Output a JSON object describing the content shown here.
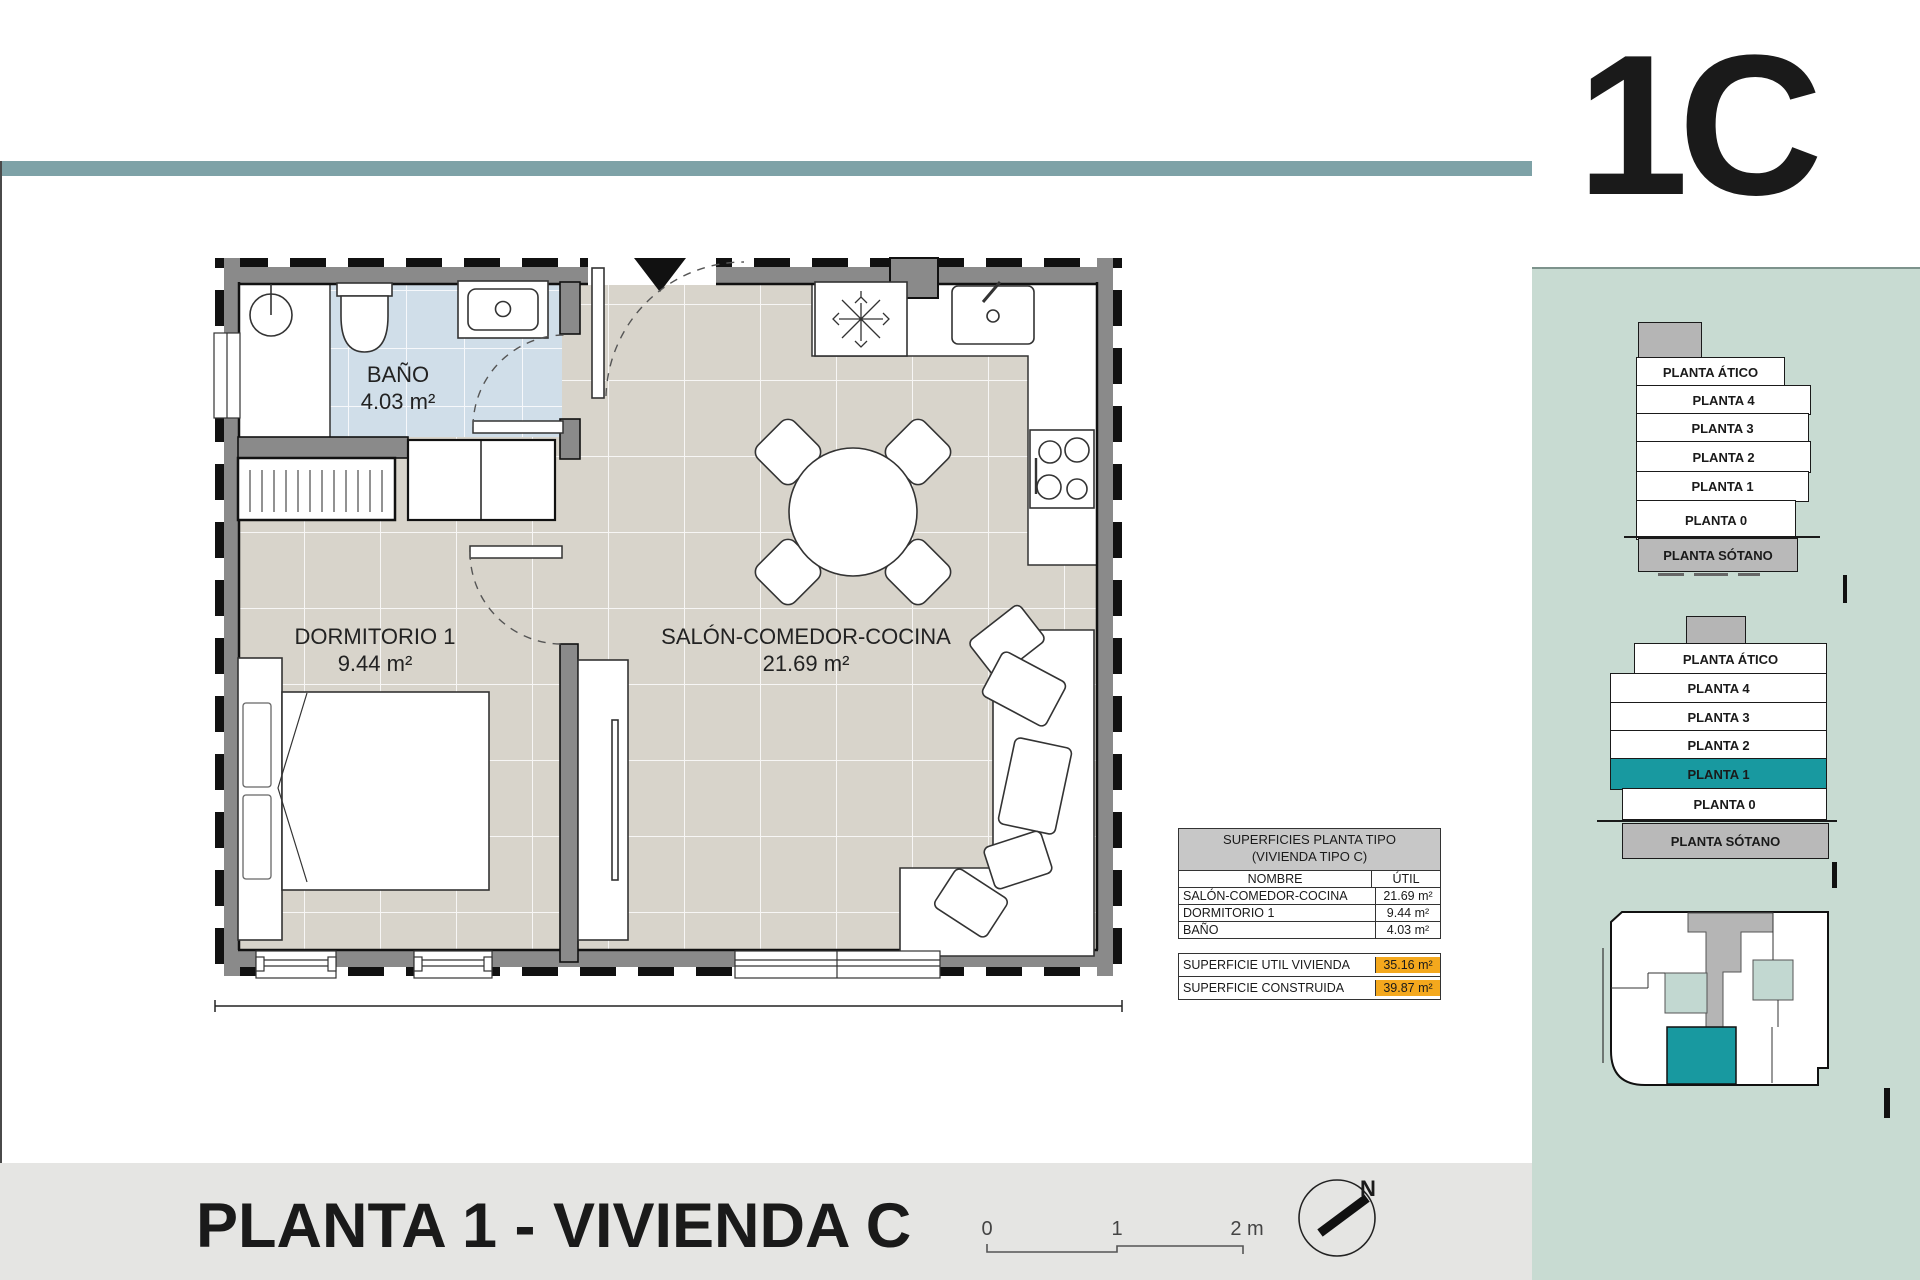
{
  "unit_label": "1C",
  "colors": {
    "accent_teal": "#1899A0",
    "ribbon": "#7EA2A7",
    "panel_bg": "#C8DBD2",
    "total_highlight": "#F4A81D",
    "bath_floor": "#D0DEE9",
    "main_floor": "#D8D4CB"
  },
  "rooms": {
    "bano": {
      "name": "BAÑO",
      "area": "4.03 m²"
    },
    "dormitorio": {
      "name": "DORMITORIO 1",
      "area": "9.44 m²"
    },
    "salon": {
      "name": "SALÓN-COMEDOR-COCINA",
      "area": "21.69 m²"
    }
  },
  "surface_table": {
    "title_line1": "SUPERFICIES PLANTA TIPO",
    "title_line2": "(VIVIENDA TIPO C)",
    "columns": {
      "name": "NOMBRE",
      "util": "ÚTIL"
    },
    "rows": [
      {
        "name": "SALÓN-COMEDOR-COCINA",
        "util": "21.69 m²"
      },
      {
        "name": "DORMITORIO 1",
        "util": "9.44 m²"
      },
      {
        "name": "BAÑO",
        "util": "4.03 m²"
      }
    ],
    "totals": [
      {
        "name": "SUPERFICIE UTIL VIVIENDA",
        "util": "35.16 m²"
      },
      {
        "name": "SUPERFICIE CONSTRUIDA",
        "util": "39.87 m²"
      }
    ]
  },
  "stack_upper": {
    "levels": [
      "PLANTA ÁTICO",
      "PLANTA 4",
      "PLANTA 3",
      "PLANTA 2",
      "PLANTA 1",
      "PLANTA 0",
      "PLANTA SÓTANO"
    ]
  },
  "stack_lower": {
    "levels": [
      "PLANTA ÁTICO",
      "PLANTA 4",
      "PLANTA 3",
      "PLANTA 2",
      "PLANTA 1",
      "PLANTA 0",
      "PLANTA SÓTANO"
    ],
    "highlighted": "PLANTA 1"
  },
  "footer": {
    "title": "PLANTA 1 - VIVIENDA C",
    "scale": {
      "t0": "0",
      "t1": "1",
      "t2": "2 m"
    },
    "north": "N"
  }
}
